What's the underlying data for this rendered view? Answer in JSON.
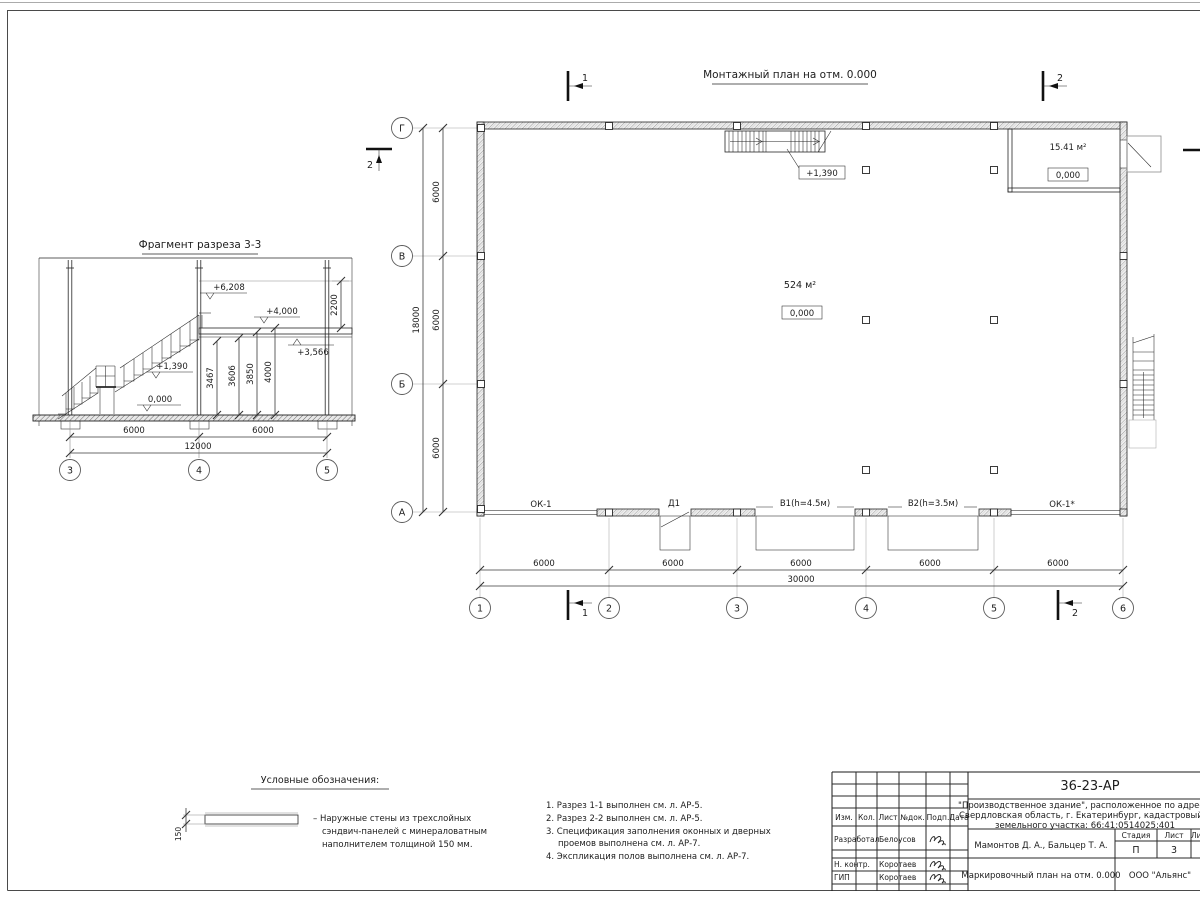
{
  "plan": {
    "title": "Монтажный план на отм. 0.000",
    "grid_cols": [
      "1",
      "2",
      "3",
      "4",
      "5",
      "6"
    ],
    "grid_rows": [
      "Г",
      "В",
      "Б",
      "А"
    ],
    "dims_h": [
      "6000",
      "6000",
      "6000",
      "6000",
      "6000"
    ],
    "dims_h_total": "30000",
    "dims_v": [
      "6000",
      "6000",
      "6000"
    ],
    "dims_v_total": "18000",
    "area_hall": "524 м²",
    "elev_hall": "0,000",
    "area_room": "15.41 м²",
    "elev_room": "0,000",
    "stair_elev": "+1,390",
    "openings": {
      "ok1": "ОК-1",
      "d1": "Д1",
      "v1": "В1(h=4.5м)",
      "v2": "В2(h=3.5м)",
      "ok1s": "ОК-1*"
    },
    "marks": {
      "m1": "1",
      "m2": "2"
    }
  },
  "section": {
    "title": "Фрагмент разреза 3-3",
    "elevs": {
      "e6208": "+6,208",
      "e4000": "+4,000",
      "e3566": "+3,566",
      "e1390": "+1,390",
      "e0": "0,000"
    },
    "vdims": {
      "d3467": "3467",
      "d3606": "3606",
      "d3850": "3850",
      "d4000": "4000",
      "d2200": "2200"
    },
    "bdims": [
      "6000",
      "6000",
      "12000"
    ],
    "grid": [
      "3",
      "4",
      "5"
    ]
  },
  "legend": {
    "title": "Условные обозначения:",
    "dim": "150",
    "lines": [
      "– Наружные стены из трехслойных",
      "сэндвич-панелей с минераловатным",
      "наполнителем толщиной 150 мм."
    ]
  },
  "notes": [
    "1. Разрез 1-1 выполнен см. л. АР-5.",
    "2. Разрез 2-2 выполнен см. л. АР-5.",
    "3. Спецификация заполнения оконных и дверных",
    "проемов выполнена см. л. АР-7.",
    "4. Экспликация полов выполнена см. л. АР-7."
  ],
  "titleblock": {
    "doc": "36-23-АР",
    "proj1": "\"Производственное здание\", расположенное по адресу:",
    "proj2": "Свердловская область, г. Екатеринбург, кадастровый н",
    "proj3": "земельного участка: 66:41:0514025:401",
    "cols": [
      "Изм.",
      "Кол.",
      "Лист",
      "№док.",
      "Подп.",
      "Дата"
    ],
    "r1_role": "Разработал",
    "r1_name": "Белоусов",
    "r2_role": "Н. контр.",
    "r2_name": "Коротаев",
    "r3_role": "ГИП",
    "r3_name": "Коротаев",
    "authors": "Мамонтов Д. А., Бальцер Т. А.",
    "stage_h": "Стадия",
    "sheet_h": "Лист",
    "sheets_h": "Листов",
    "stage": "П",
    "sheet": "3",
    "sheet_title": "Маркировочный план на отм. 0.000",
    "company": "ООО \"Альянс\""
  }
}
